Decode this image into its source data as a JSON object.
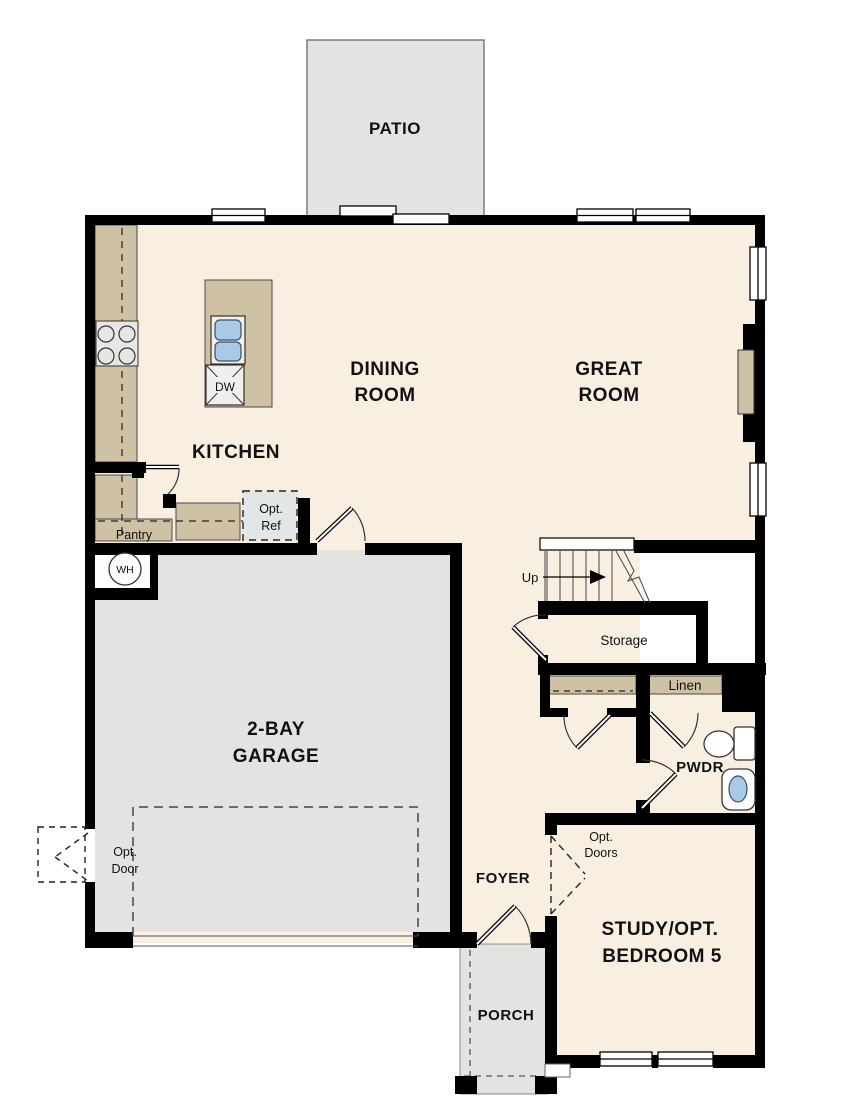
{
  "colors": {
    "floor_beige": "#f8efe1",
    "hardscape_gray": "#e4e3e1",
    "cabinet_tan": "#cfc1a3",
    "wall_black": "#000000",
    "fixture_blue": "#a9c9e6",
    "appliance_gray": "#e6e6e4"
  },
  "rooms": {
    "patio": {
      "label": "PATIO"
    },
    "dining_room": {
      "line1": "DINING",
      "line2": "ROOM"
    },
    "great_room": {
      "line1": "GREAT",
      "line2": "ROOM"
    },
    "kitchen": {
      "label": "KITCHEN"
    },
    "garage": {
      "line1": "2-BAY",
      "line2": "GARAGE"
    },
    "foyer": {
      "label": "FOYER"
    },
    "porch": {
      "label": "PORCH"
    },
    "powder_room": {
      "label": "PWDR"
    },
    "study": {
      "line1": "STUDY/OPT.",
      "line2": "BEDROOM 5"
    }
  },
  "features": {
    "pantry": {
      "label": "Pantry"
    },
    "optional_refrigerator": {
      "line1": "Opt.",
      "line2": "Ref"
    },
    "dishwasher": {
      "label": "DW"
    },
    "water_heater": {
      "label": "WH"
    },
    "stairs": {
      "direction_label": "Up"
    },
    "storage": {
      "label": "Storage"
    },
    "linen": {
      "label": "Linen"
    },
    "optional_doors": {
      "line1": "Opt.",
      "line2": "Doors"
    },
    "optional_garage_side_door": {
      "line1": "Opt.",
      "line2": "Door"
    }
  }
}
